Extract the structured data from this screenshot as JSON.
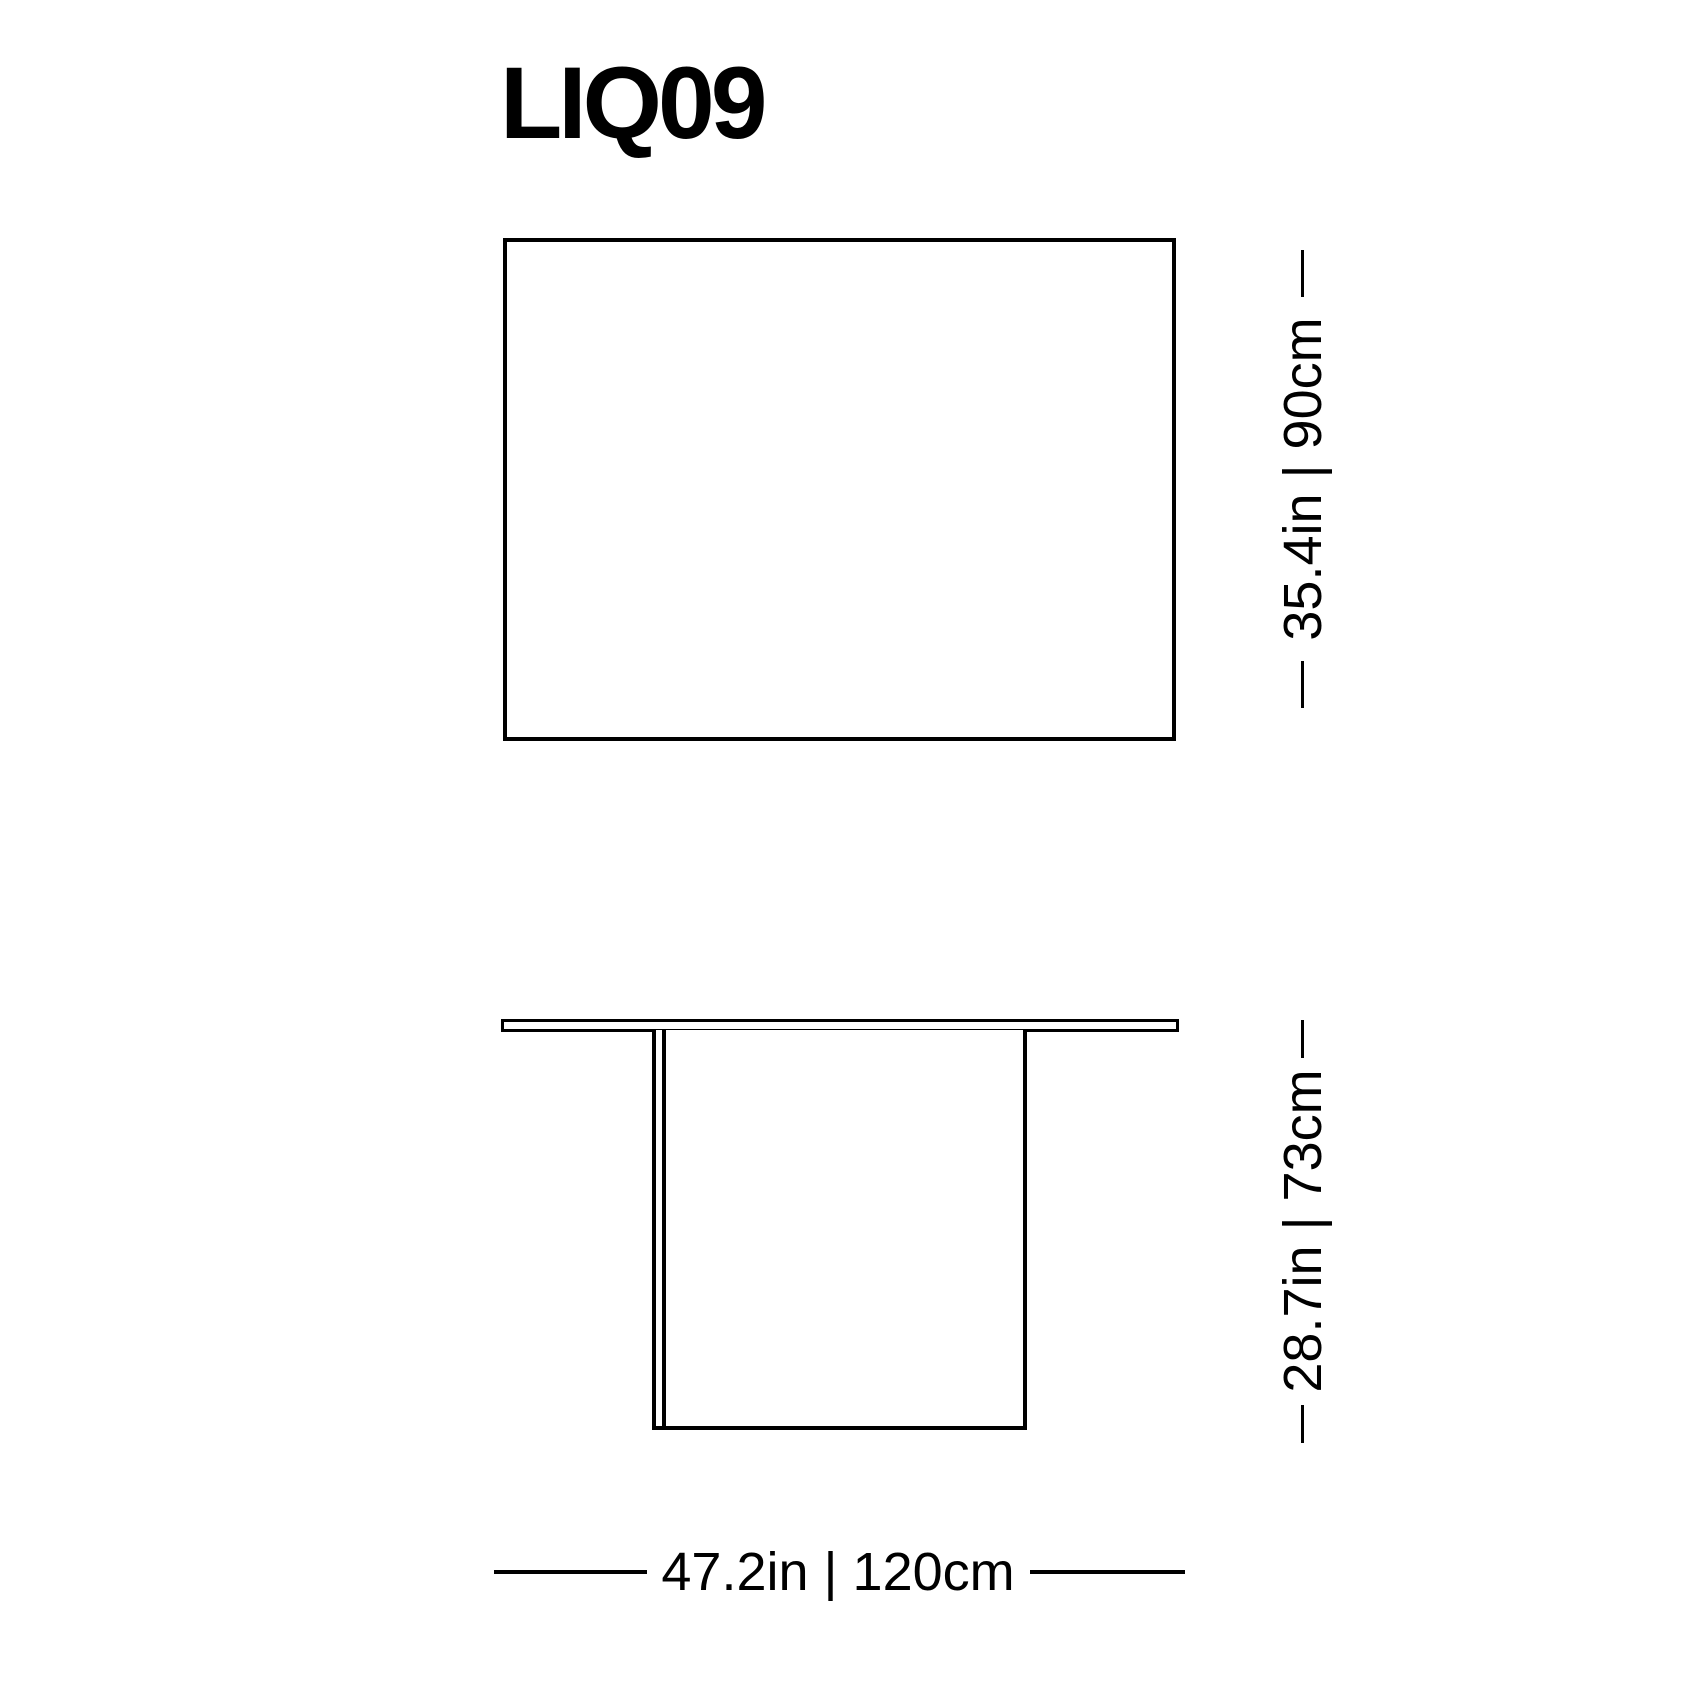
{
  "title": "LIQ09",
  "colors": {
    "background": "#ffffff",
    "line": "#000000",
    "text": "#000000"
  },
  "dimensions": {
    "depth_label": "35.4in | 90cm",
    "height_label": "28.7in | 73cm",
    "width_label": "47.2in | 120cm"
  }
}
